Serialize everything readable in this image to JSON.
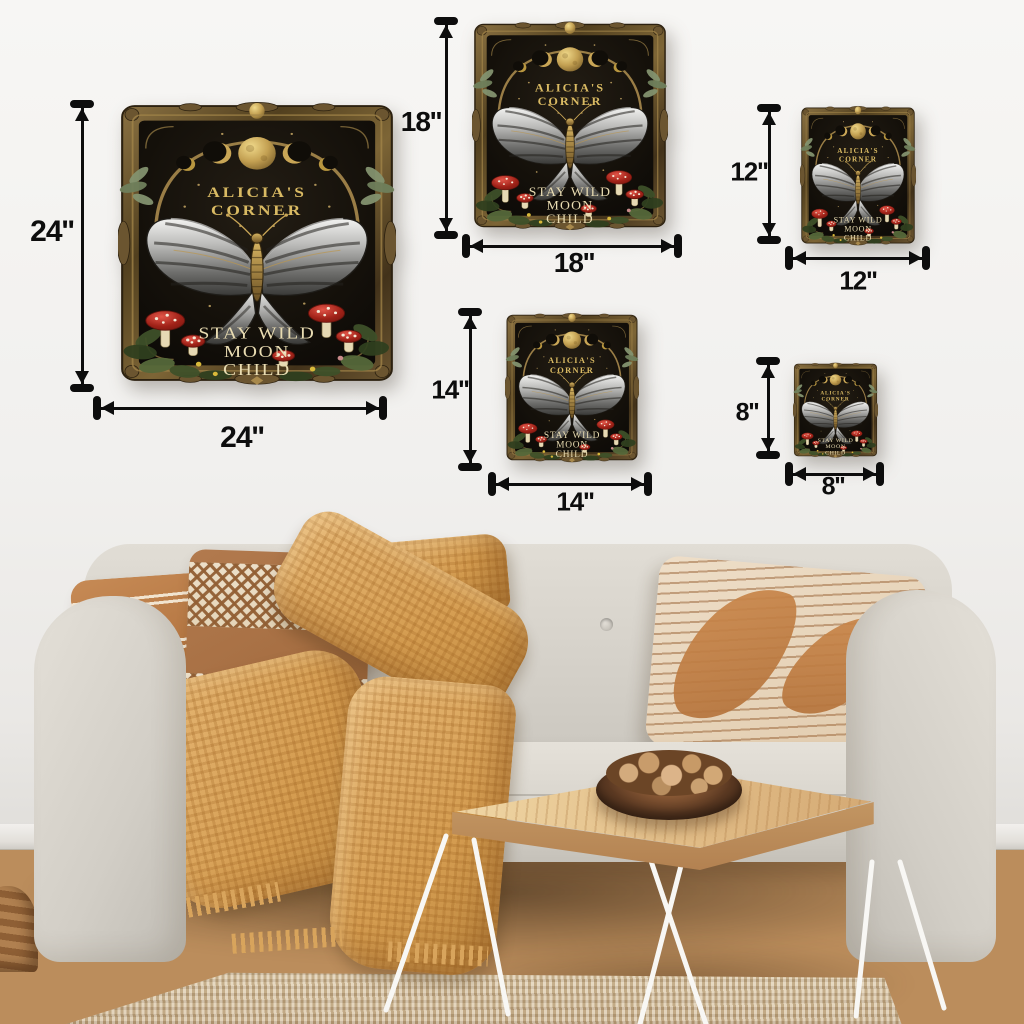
{
  "sign_artwork": {
    "brand_line1": "ALICIA'S",
    "brand_line2": "CORNER",
    "quote_line1": "STAY WILD",
    "quote_line2": "MOON",
    "quote_line3": "CHILD",
    "motifs": [
      "triple-moon-icon",
      "butterfly-icon",
      "mushroom-icon",
      "foliage-icon",
      "crescent-moon-icon"
    ],
    "colors": {
      "frame_bronze": "#6b5530",
      "panel_black": "#100d08",
      "moon_gold": "#c9a656",
      "brand_text_gold": "#d9ba63",
      "quote_text_cream": "#e9dcb2",
      "mushroom_red": "#a02218",
      "wing_silver": "#b9b9b7"
    }
  },
  "sizes": [
    {
      "id": "24in",
      "height_label": "24''",
      "width_label": "24''"
    },
    {
      "id": "18in",
      "height_label": "18''",
      "width_label": "18''"
    },
    {
      "id": "12in",
      "height_label": "12''",
      "width_label": "12''"
    },
    {
      "id": "14in",
      "height_label": "14''",
      "width_label": "14''"
    },
    {
      "id": "8in",
      "height_label": "8''",
      "width_label": "8''"
    }
  ],
  "scene": {
    "colors": {
      "wall": "#f1f0ee",
      "sofa_fabric": "#d6d2ca",
      "pillow_terracotta": "#b0713d",
      "pillow_diamond_brown": "#9c6539",
      "pillow_cream": "#eedec8",
      "blanket_mustard": "#d49c50",
      "floor_wood": "#bb8d5c",
      "rug_jute": "#d3c0a0",
      "table_wood": "#e2bd87",
      "dimension_arrow": "#0d0d0d"
    }
  }
}
